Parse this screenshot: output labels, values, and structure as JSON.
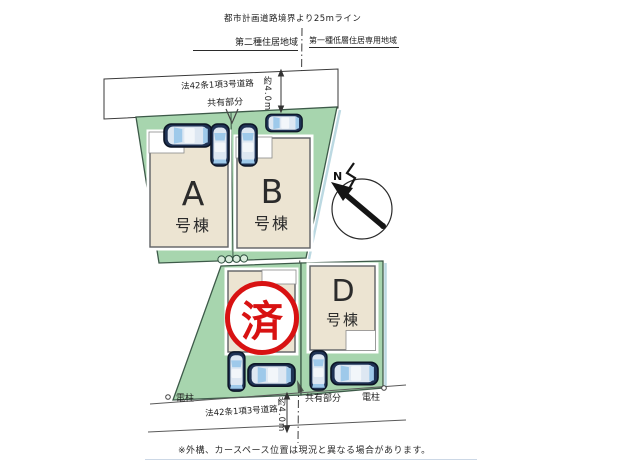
{
  "header": {
    "planning_line": "都市計画道路境界より25mライン",
    "zoning_left": "第二種住居地域",
    "zoning_right": "第一種低層住居専用地域"
  },
  "top_road": {
    "label": "法42条1項3号道路",
    "shared": "共有部分",
    "width": "約4.0m"
  },
  "plots": {
    "a": {
      "letter": "A",
      "suffix": "号棟"
    },
    "b": {
      "letter": "B",
      "suffix": "号棟"
    },
    "d": {
      "letter": "D",
      "suffix": "号棟"
    },
    "sold": {
      "stamp": "済"
    }
  },
  "compass": {
    "label": "N"
  },
  "bottom_road": {
    "pole_left": "電柱",
    "label": "法42条1項3号道路",
    "width": "約4.0m",
    "shared": "共有部分",
    "pole_right": "電柱"
  },
  "note": "※外構、カースペース位置は現況と異なる場合があります。",
  "colors": {
    "plot_green": "#a7d5ae",
    "building_beige": "#ece4d2",
    "stamp_red": "#d81212",
    "car_body": "#1f3254",
    "car_glass": "#9ec9ea"
  }
}
